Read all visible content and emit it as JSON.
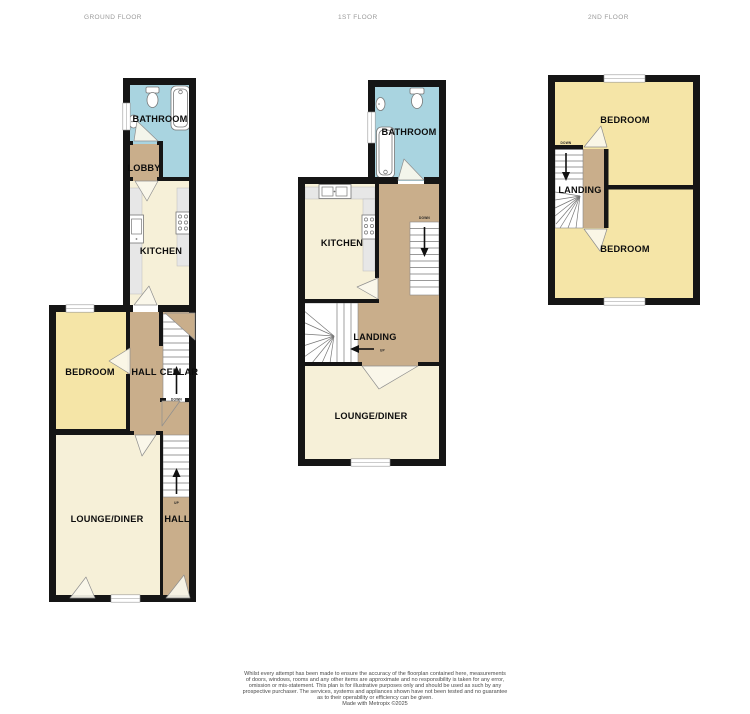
{
  "titles": {
    "ground": "GROUND FLOOR",
    "first": "1ST FLOOR",
    "second": "2ND FLOOR"
  },
  "colors": {
    "wall": "#151515",
    "bathroom_blue": "#a9d4e0",
    "hall_tan": "#c9ae8b",
    "living_cream": "#f6f0d8",
    "bedroom_yellow": "#f5e5a7",
    "counter_gray": "#e7e7e7",
    "title_gray": "#9a9a9a"
  },
  "floors": {
    "ground": {
      "labels": {
        "bathroom": "BATHROOM",
        "lobby": "LOBBY",
        "kitchen": "KITCHEN",
        "bedroom": "BEDROOM",
        "hall_upper": "HALL",
        "cellar": "CELLAR",
        "lounge": "LOUNGE/DINER",
        "hall_lower": "HALL"
      },
      "stairs": {
        "cellar_direction": "DOWN",
        "hall_direction": "UP"
      }
    },
    "first": {
      "labels": {
        "bathroom": "BATHROOM",
        "kitchen": "KITCHEN",
        "landing": "LANDING",
        "lounge": "LOUNGE/DINER"
      },
      "stairs": {
        "right_direction": "DOWN",
        "winder_direction": "UP"
      }
    },
    "second": {
      "labels": {
        "bedroom_front": "BEDROOM",
        "landing": "LANDING",
        "bedroom_back": "BEDROOM"
      },
      "stairs": {
        "direction": "DOWN"
      }
    }
  },
  "disclaimer": {
    "lines": [
      "Whilst every attempt has been made to ensure the accuracy of the floorplan contained here, measurements",
      "of doors, windows, rooms and any other items are approximate and no responsibility is taken for any error,",
      "omission or mis-statement. This plan is for illustrative purposes only and should be used as such by any",
      "prospective purchaser. The services, systems and appliances shown have not been tested and no guarantee",
      "as to their operability or efficiency can be given."
    ],
    "credit": "Made with Metropix ©2025"
  }
}
